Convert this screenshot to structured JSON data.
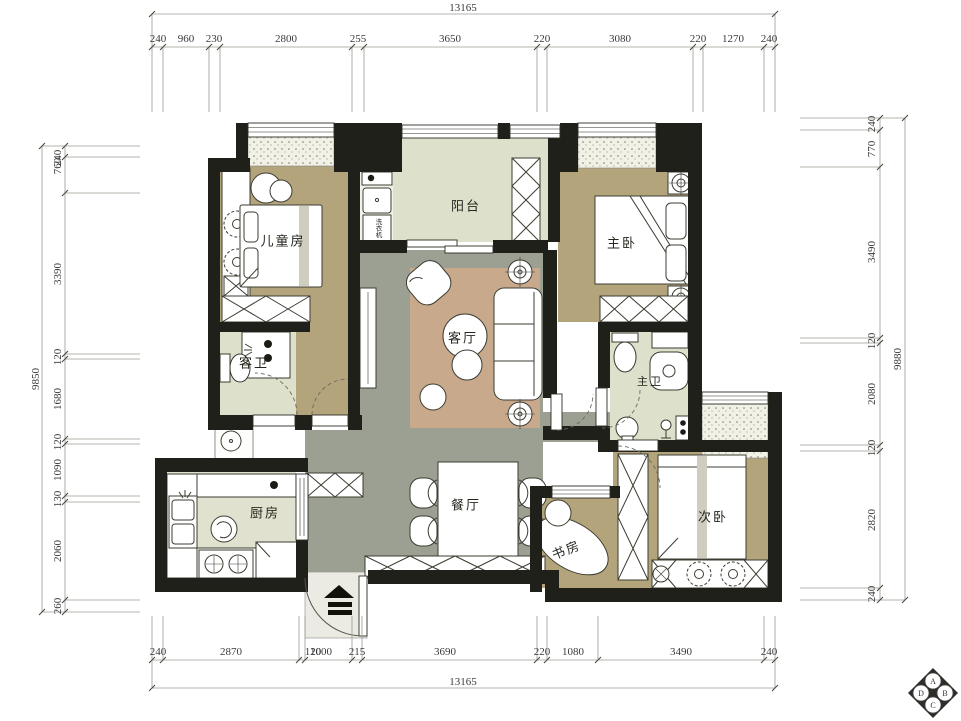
{
  "drawing": {
    "type": "apartment floor plan"
  },
  "rooms": {
    "children_bedroom": "儿童房",
    "balcony": "阳台",
    "master_bedroom": "主卧",
    "guest_bathroom": "客卫",
    "living_room": "客厅",
    "master_bathroom": "主卫",
    "kitchen": "厨房",
    "dining_room": "餐厅",
    "study": "书房",
    "second_bedroom": "次卧",
    "washing_machine": "洗衣机"
  },
  "dimensions": {
    "top": {
      "total": "13165",
      "segments": [
        "240",
        "960",
        "230",
        "2800",
        "255",
        "3650",
        "220",
        "3080",
        "220",
        "1270",
        "240"
      ]
    },
    "bottom": {
      "total": "13165",
      "segments": [
        "240",
        "2870",
        "120",
        "1000",
        "215",
        "3690",
        "220",
        "1080",
        "3490",
        "240"
      ]
    },
    "left": {
      "total": "9850",
      "segments": [
        "240",
        "760",
        "3390",
        "120",
        "1680",
        "120",
        "1090",
        "130",
        "2060",
        "260"
      ]
    },
    "right": {
      "total": "9880",
      "segments": [
        "240",
        "770",
        "3490",
        "120",
        "2080",
        "120",
        "2820",
        "240"
      ]
    }
  },
  "logo": {
    "badges": [
      "A",
      "B",
      "C",
      "D"
    ]
  },
  "colors": {
    "wall": "#20201a",
    "floor_tan": "#b3a47c",
    "floor_grey": "#9ba093",
    "floor_sage": "#dde0ca",
    "floor_kitchen": "#e0e2cf",
    "rug": "#c9a98c",
    "hatch_bg": "#f2f1e6",
    "dim_line": "#8a8a8a"
  }
}
